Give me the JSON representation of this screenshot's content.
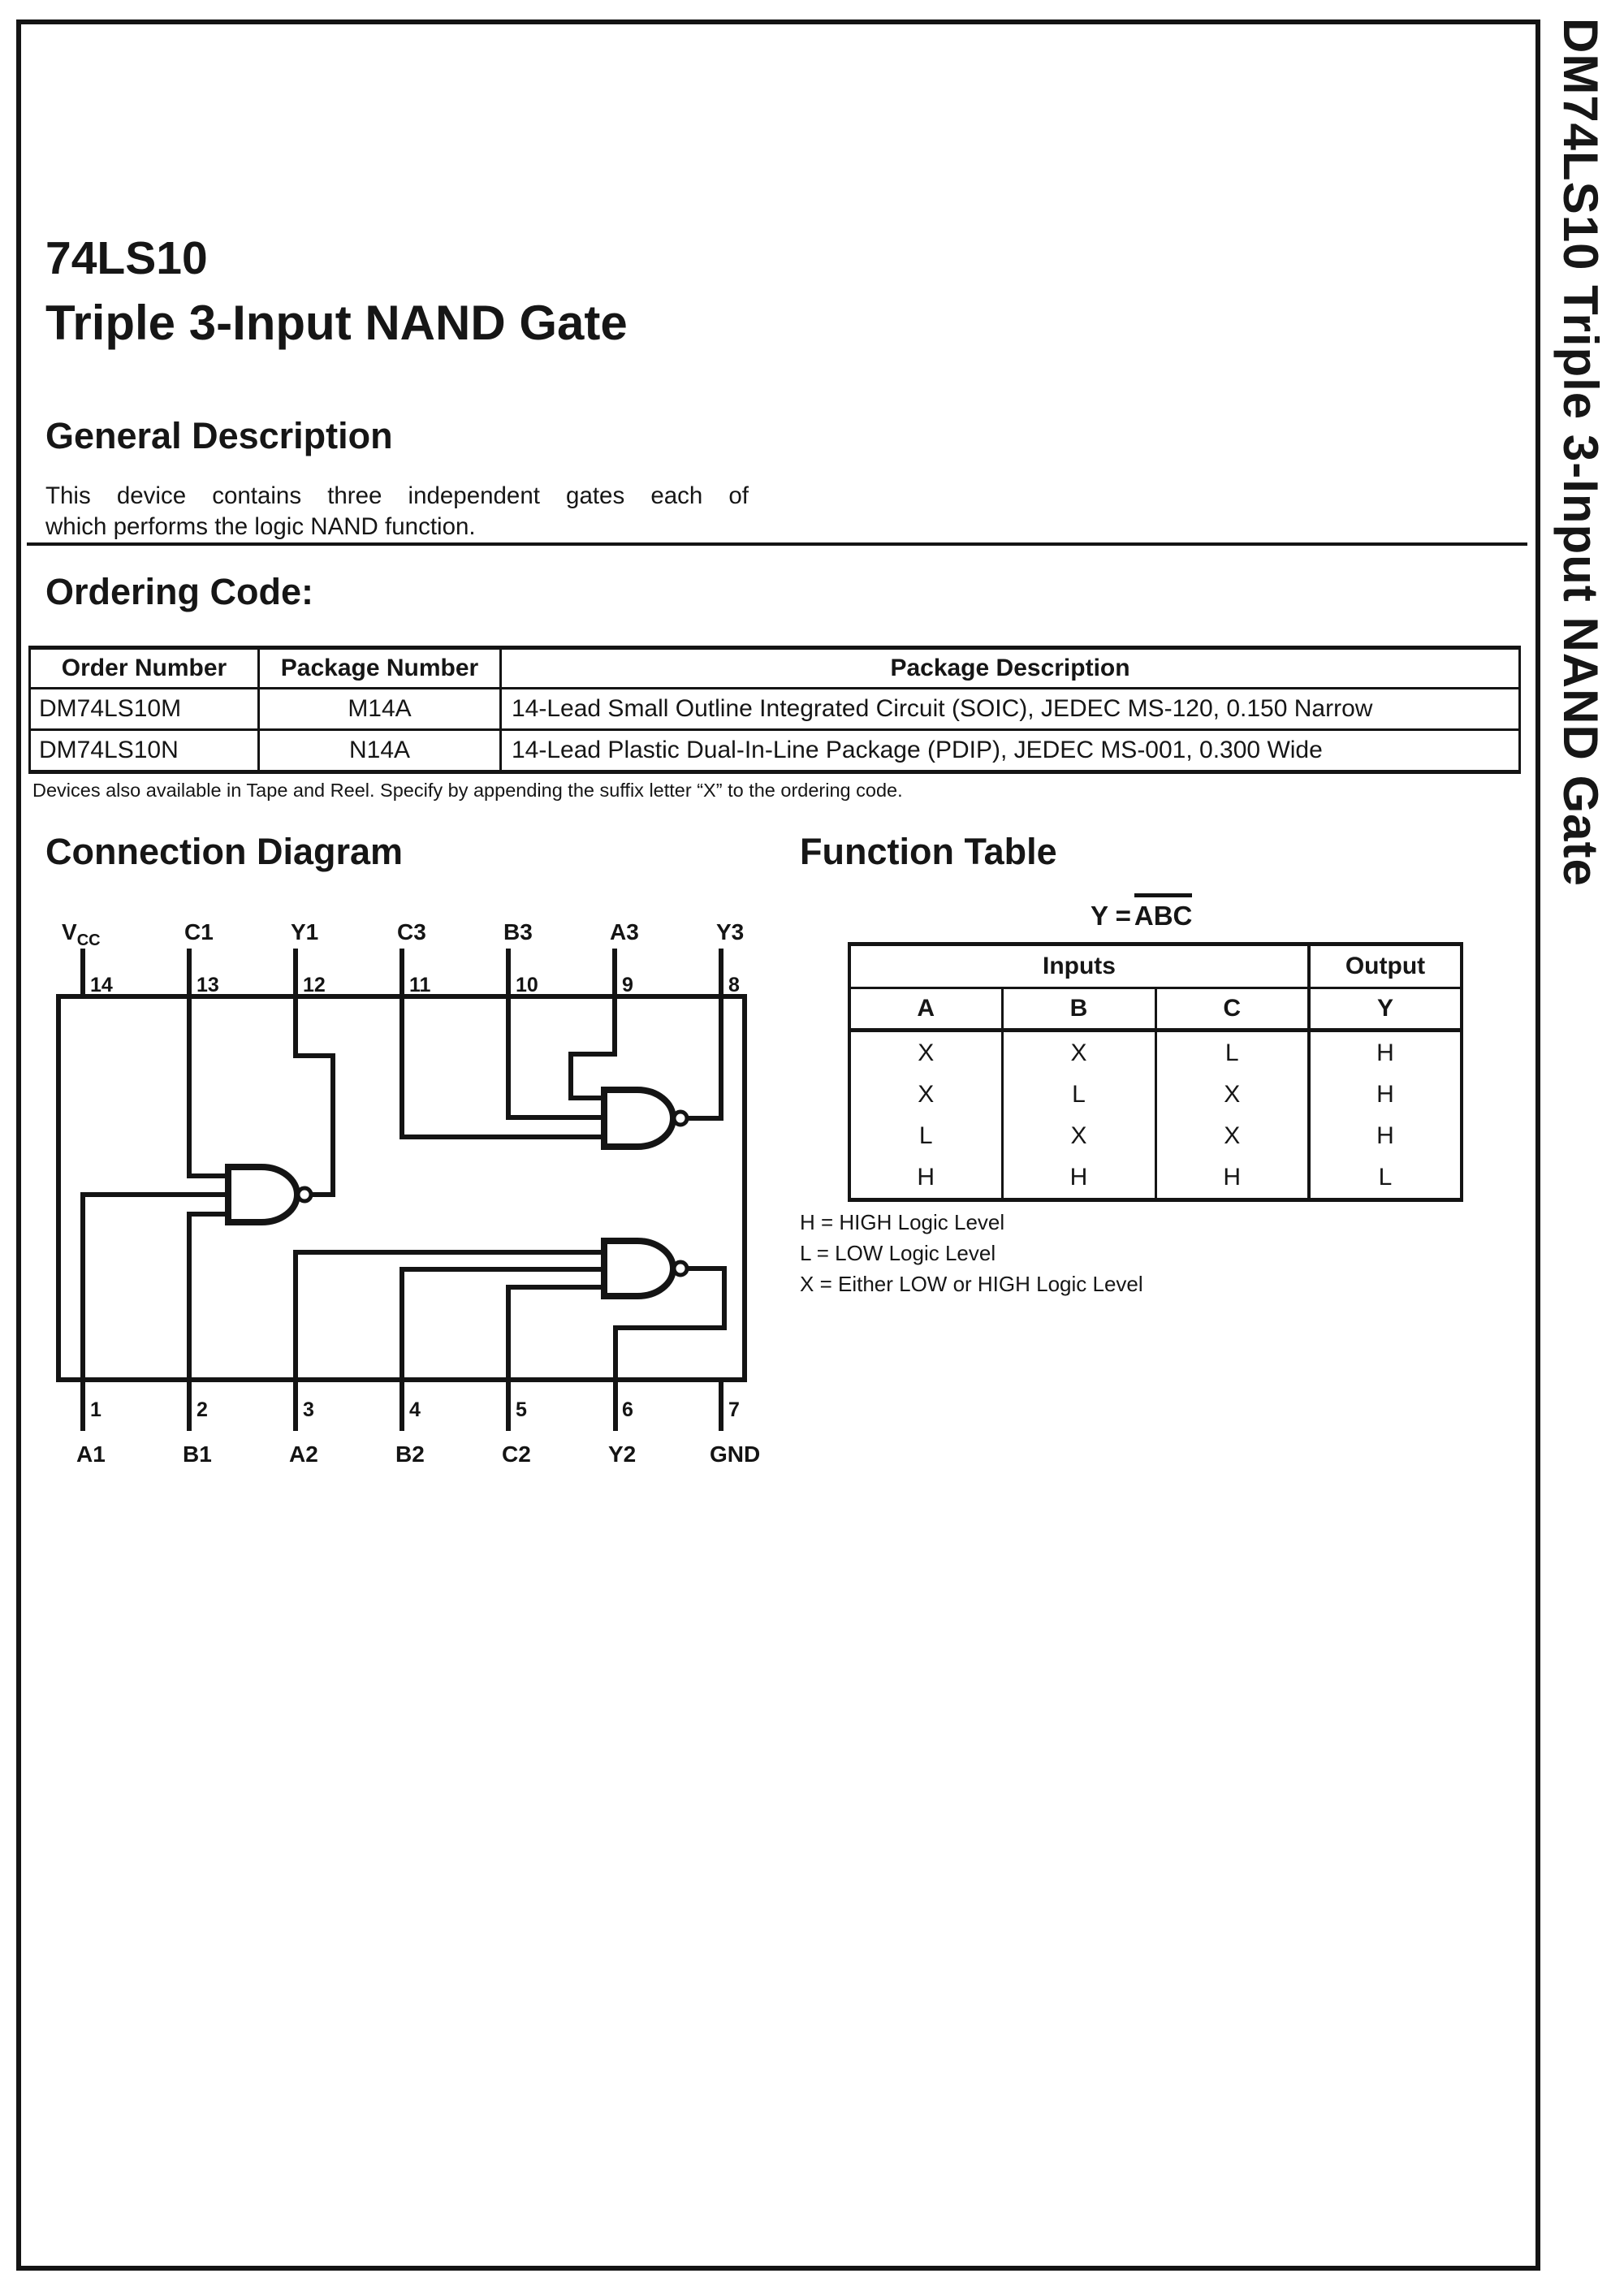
{
  "page": {
    "part_number": "74LS10",
    "part_title": "Triple 3-Input NAND Gate",
    "sidebar_title": "DM74LS10 Triple 3-Input NAND Gate"
  },
  "general_description": {
    "heading": "General Description",
    "lines": [
      "This device contains three independent gates each of",
      "which performs the logic NAND function."
    ]
  },
  "ordering": {
    "heading": "Ordering Code:",
    "headers": [
      "Order Number",
      "Package Number",
      "Package Description"
    ],
    "rows": [
      [
        "DM74LS10M",
        "M14A",
        "14-Lead Small Outline Integrated Circuit (SOIC), JEDEC MS-120, 0.150 Narrow"
      ],
      [
        "DM74LS10N",
        "N14A",
        "14-Lead Plastic Dual-In-Line Package (PDIP), JEDEC MS-001, 0.300 Wide"
      ]
    ],
    "note": "Devices also available in Tape and Reel. Specify by appending the suffix letter “X” to the ordering code."
  },
  "connection_diagram": {
    "heading": "Connection Diagram",
    "top_pins": [
      {
        "label_main": "V",
        "label_sub": "CC",
        "number": "14"
      },
      {
        "label": "C1",
        "number": "13"
      },
      {
        "label": "Y1",
        "number": "12"
      },
      {
        "label": "C3",
        "number": "11"
      },
      {
        "label": "B3",
        "number": "10"
      },
      {
        "label": "A3",
        "number": "9"
      },
      {
        "label": "Y3",
        "number": "8"
      }
    ],
    "bottom_pins": [
      {
        "label": "A1",
        "number": "1"
      },
      {
        "label": "B1",
        "number": "2"
      },
      {
        "label": "A2",
        "number": "3"
      },
      {
        "label": "B2",
        "number": "4"
      },
      {
        "label": "C2",
        "number": "5"
      },
      {
        "label": "Y2",
        "number": "6"
      },
      {
        "label": "GND",
        "number": "7"
      }
    ]
  },
  "function_table": {
    "heading": "Function Table",
    "equation": {
      "lhs": "Y =",
      "overlined": "ABC"
    },
    "group_headers": [
      "Inputs",
      "Output"
    ],
    "col_headers": [
      "A",
      "B",
      "C",
      "Y"
    ],
    "rows": [
      [
        "X",
        "X",
        "L",
        "H"
      ],
      [
        "X",
        "L",
        "X",
        "H"
      ],
      [
        "L",
        "X",
        "X",
        "H"
      ],
      [
        "H",
        "H",
        "H",
        "L"
      ]
    ],
    "notes": [
      "H = HIGH Logic Level",
      "L = LOW Logic Level",
      "X = Either LOW or HIGH Logic Level"
    ]
  }
}
